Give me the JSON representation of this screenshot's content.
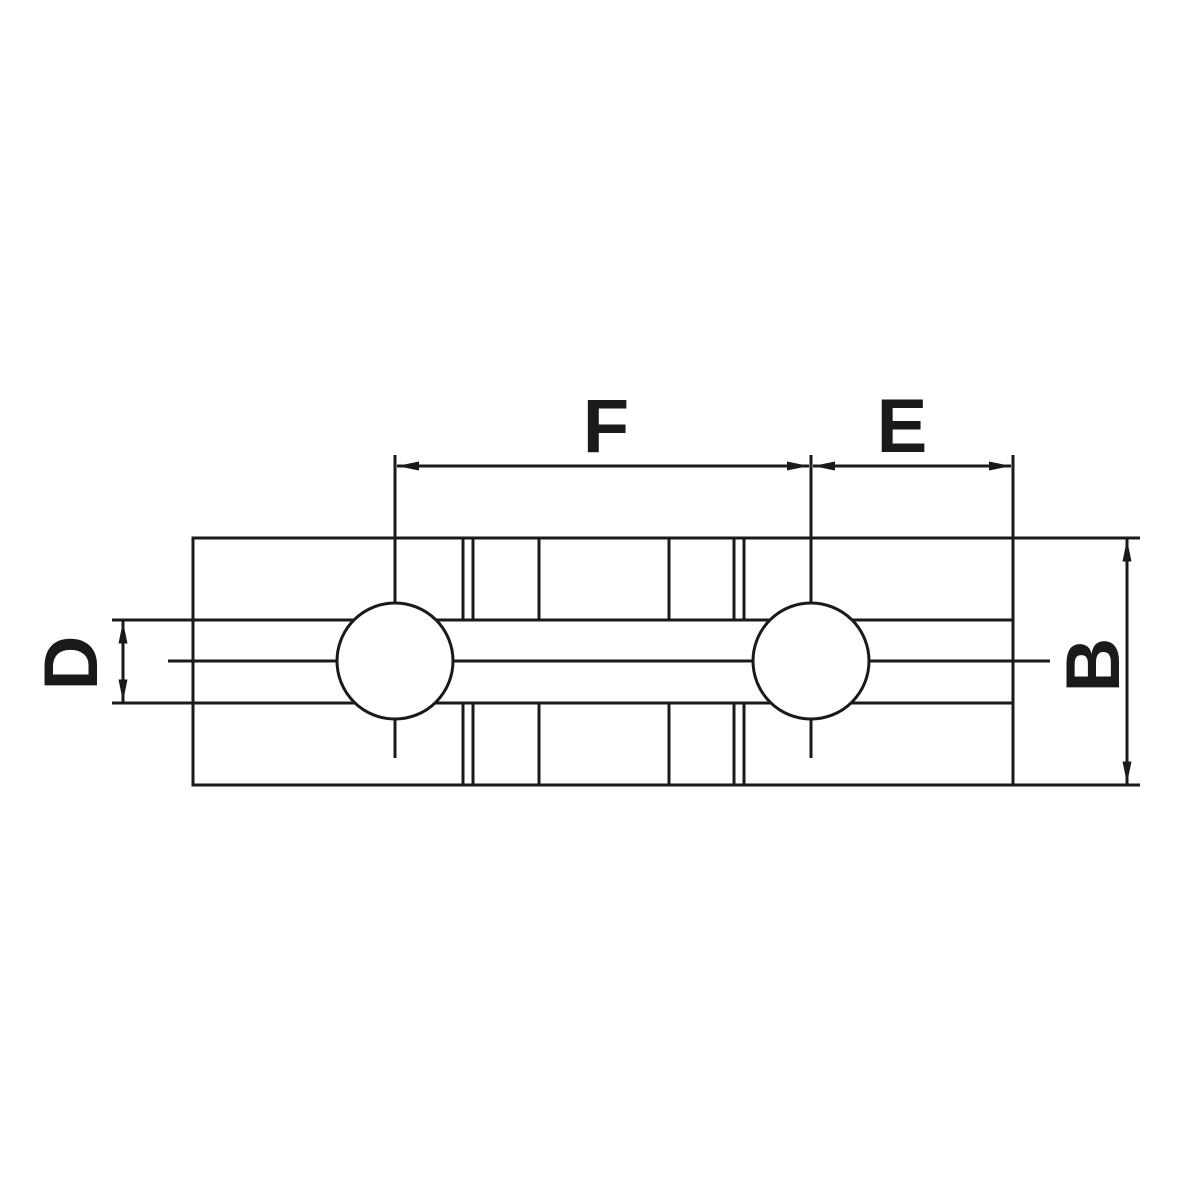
{
  "drawing": {
    "labels": {
      "f": "F",
      "e": "E",
      "d": "D",
      "b": "B"
    },
    "colors": {
      "line": "#1a1a1a",
      "background": "#ffffff",
      "hole_fill": "#ffffff"
    }
  }
}
